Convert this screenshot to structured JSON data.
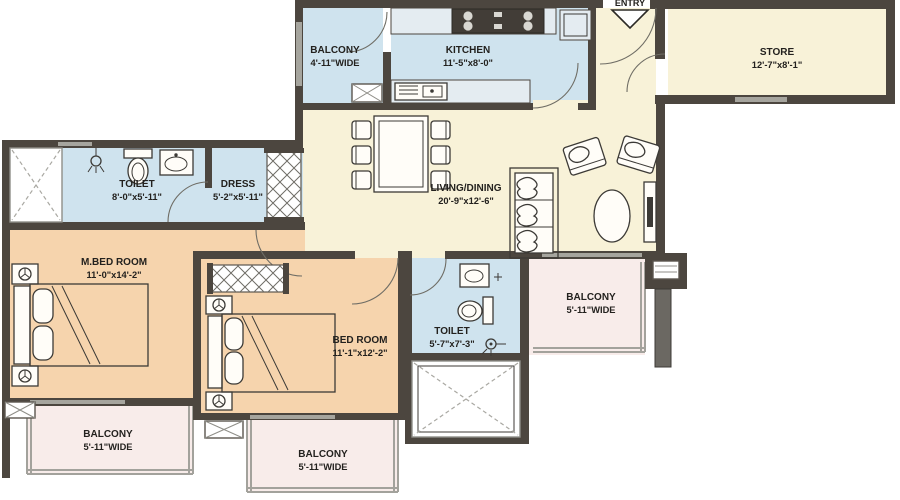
{
  "title": "Apartment Floor Plan",
  "colors": {
    "wall": "#4c463f",
    "window": "#a6a59e",
    "room_blue": "#cfe3ee",
    "room_cream": "#f8f2d8",
    "room_peach": "#f6d4ad",
    "room_pink": "#f8ecea"
  },
  "entry_marker": {
    "label": "ENTRY"
  },
  "rooms": {
    "balcony_top": {
      "name": "BALCONY",
      "dims": "4'-11\"WIDE"
    },
    "kitchen": {
      "name": "KITCHEN",
      "dims": "11'-5\"x8'-0\""
    },
    "store": {
      "name": "STORE",
      "dims": "12'-7\"x8'-1\""
    },
    "toilet1": {
      "name": "TOILET",
      "dims": "8'-0\"x5'-11\""
    },
    "dress": {
      "name": "DRESS",
      "dims": "5'-2\"x5'-11\""
    },
    "living": {
      "name": "LIVING/DINING",
      "dims": "20'-9\"x12'-6\""
    },
    "mbed": {
      "name": "M.BED ROOM",
      "dims": "11'-0\"x14'-2\""
    },
    "bed2": {
      "name": "BED ROOM",
      "dims": "11'-1\"x12'-2\""
    },
    "toilet2": {
      "name": "TOILET",
      "dims": "5'-7\"x7'-3\""
    },
    "balcony_right": {
      "name": "BALCONY",
      "dims": "5'-11\"WIDE"
    },
    "balcony_bottom_left": {
      "name": "BALCONY",
      "dims": "5'-11\"WIDE"
    },
    "balcony_bottom_center": {
      "name": "BALCONY",
      "dims": "5'-11\"WIDE"
    }
  }
}
